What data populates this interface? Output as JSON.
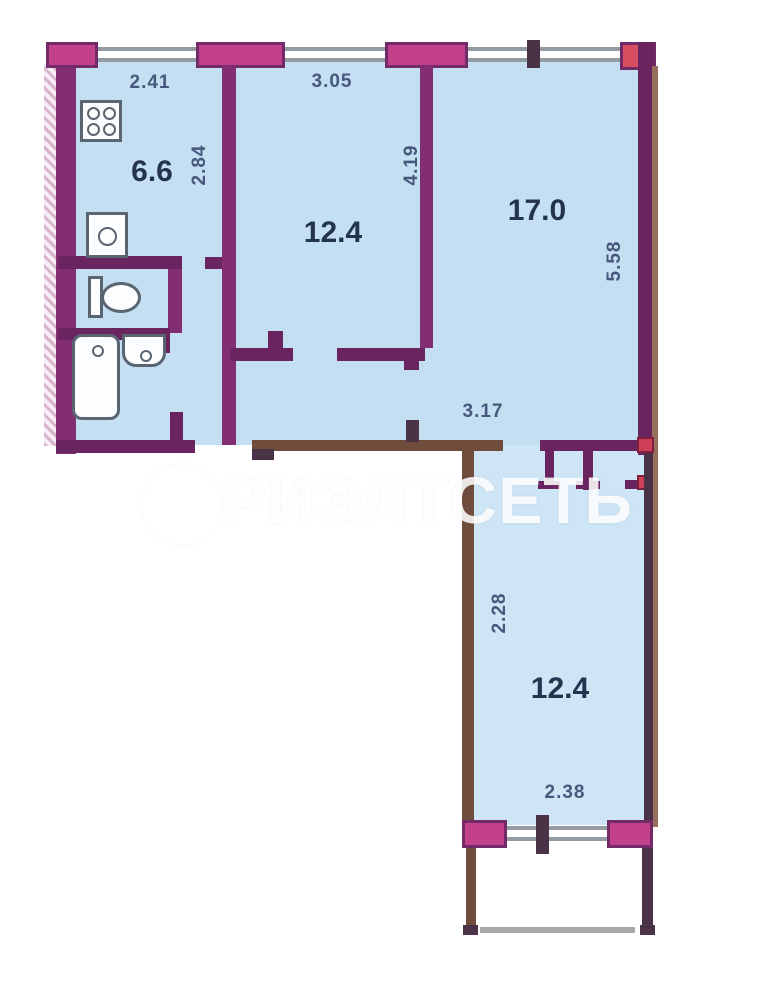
{
  "watermark": {
    "logo_letter": "Р",
    "text": "РИЭЛТСЕТЬ"
  },
  "rooms": {
    "kitchen": {
      "area": "6.6",
      "top_dim": "2.41",
      "side_dim": "2.84"
    },
    "bedroom": {
      "area": "12.4",
      "top_dim": "3.05",
      "side_dim": "4.19"
    },
    "living": {
      "area": "17.0",
      "side_dim": "5.58"
    },
    "hall": {
      "width_dim": "3.17"
    },
    "lower_room": {
      "area": "12.4",
      "side_dim": "2.28",
      "bottom_dim": "2.38"
    }
  },
  "fixtures": [
    "stove-icon",
    "kitchen-sink-icon",
    "toilet-icon",
    "bathtub-icon",
    "washbasin-icon"
  ],
  "colors": {
    "wall_magenta": "#832d72",
    "wall_brown": "#6f4c3c",
    "pier_pink": "#c2418a",
    "accent_red": "#cf3f55",
    "room_fill": "#c5dff2",
    "glass_gray": "#949ba3",
    "dim_text": "#46587c",
    "area_text": "#24344f"
  }
}
